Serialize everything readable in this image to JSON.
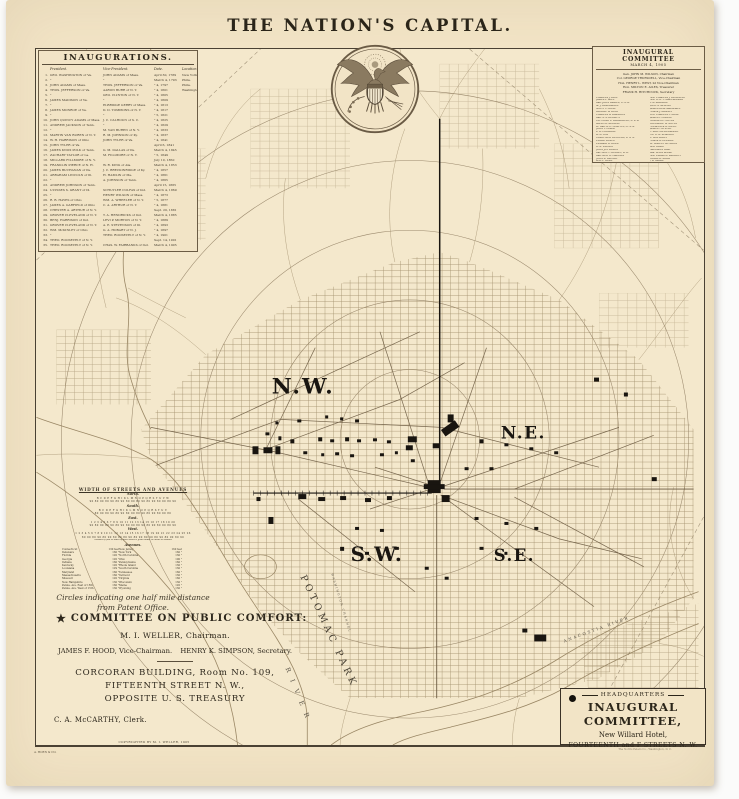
{
  "page": {
    "title": "THE NATION'S CAPITAL."
  },
  "colors": {
    "paper": "#f2e4c6",
    "ink": "#352e23",
    "black": "#191510",
    "map_line": "#9a8765",
    "map_dark": "#6b5a41",
    "map_faint": "#8a775a"
  },
  "inaugurations": {
    "title": "INAUGURATIONS.",
    "columns": {
      "president": "President.",
      "vice": "Vice-President.",
      "date": "Date.",
      "location": "Location."
    },
    "rows": [
      {
        "n": "1.",
        "president": "GEO. WASHINGTON of Va.",
        "vice": "JOHN ADAMS of Mass.",
        "date": "April 30, 1789",
        "loc": "New York"
      },
      {
        "n": "2.",
        "president": "\"",
        "vice": "\"",
        "date": "March 4, 1793",
        "loc": "Phila."
      },
      {
        "n": "3.",
        "president": "JOHN ADAMS of Mass.",
        "vice": "THOS. JEFFERSON of Va.",
        "date": "\" 4, 1797",
        "loc": "Phila."
      },
      {
        "n": "4.",
        "president": "THOS. JEFFERSON of Va.",
        "vice": "AARON BURR of N. Y.",
        "date": "\" 4, 1801",
        "loc": "Washington"
      },
      {
        "n": "5.",
        "president": "\"",
        "vice": "GEO. CLINTON of N. Y.",
        "date": "\" 4, 1805",
        "loc": ""
      },
      {
        "n": "6.",
        "president": "JAMES MADISON of Va.",
        "vice": "\"",
        "date": "\" 4, 1809",
        "loc": ""
      },
      {
        "n": "7.",
        "president": "\"",
        "vice": "ELBRIDGE GERRY of Mass.",
        "date": "\" 4, 1813",
        "loc": ""
      },
      {
        "n": "8.",
        "president": "JAMES MONROE of Va.",
        "vice": "D. D. TOMPKINS of N. Y.",
        "date": "\" 4, 1817",
        "loc": ""
      },
      {
        "n": "9.",
        "president": "\"",
        "vice": "\"",
        "date": "\" 5, 1821",
        "loc": ""
      },
      {
        "n": "10.",
        "president": "JOHN QUINCY ADAMS of Mass.",
        "vice": "J. C. CALHOUN of S. C.",
        "date": "\" 4, 1825",
        "loc": ""
      },
      {
        "n": "11.",
        "president": "ANDREW JACKSON of Tenn.",
        "vice": "\"",
        "date": "\" 4, 1829",
        "loc": ""
      },
      {
        "n": "12.",
        "president": "\"",
        "vice": "M. VAN BUREN of N. Y.",
        "date": "\" 4, 1833",
        "loc": ""
      },
      {
        "n": "13.",
        "president": "MARTIN VAN BUREN of N. Y.",
        "vice": "R. M. JOHNSON of Ky.",
        "date": "\" 4, 1837",
        "loc": ""
      },
      {
        "n": "14.",
        "president": "W. H. HARRISON of Ohio",
        "vice": "JOHN TYLER of Va.",
        "date": "\" 4, 1841",
        "loc": ""
      },
      {
        "n": "15.",
        "president": "JOHN TYLER of Va.",
        "vice": "",
        "date": "April 6, 1841",
        "loc": ""
      },
      {
        "n": "16.",
        "president": "JAMES KNOX POLK of Tenn.",
        "vice": "G. M. DALLAS of Pa.",
        "date": "March 4, 1845",
        "loc": ""
      },
      {
        "n": "17.",
        "president": "ZACHARY TAYLOR of La.",
        "vice": "M. FILLMORE of N. Y.",
        "date": "\" 5, 1849",
        "loc": ""
      },
      {
        "n": "18.",
        "president": "MILLARD FILLMORE of N. Y.",
        "vice": "",
        "date": "July 10, 1850",
        "loc": ""
      },
      {
        "n": "19.",
        "president": "FRANKLIN PIERCE of N. H.",
        "vice": "W. R. KING of Ala.",
        "date": "March 4, 1853",
        "loc": ""
      },
      {
        "n": "20.",
        "president": "JAMES BUCHANAN of Pa.",
        "vice": "J. C. BRECKINRIDGE of Ky.",
        "date": "\" 4, 1857",
        "loc": ""
      },
      {
        "n": "21.",
        "president": "ABRAHAM LINCOLN of Ill.",
        "vice": "H. HAMLIN of Me.",
        "date": "\" 4, 1861",
        "loc": ""
      },
      {
        "n": "22.",
        "president": "\"",
        "vice": "A. JOHNSON of Tenn.",
        "date": "\" 4, 1865",
        "loc": ""
      },
      {
        "n": "23.",
        "president": "ANDREW JOHNSON of Tenn.",
        "vice": "",
        "date": "April 15, 1865",
        "loc": ""
      },
      {
        "n": "24.",
        "president": "ULYSSES S. GRANT of Ill.",
        "vice": "SCHUYLER COLFAX of Ind.",
        "date": "March 4, 1869",
        "loc": ""
      },
      {
        "n": "25.",
        "president": "\"",
        "vice": "HENRY WILSON of Mass.",
        "date": "\" 4, 1873",
        "loc": ""
      },
      {
        "n": "26.",
        "president": "R. B. HAYES of Ohio",
        "vice": "WM. A. WHEELER of N. Y.",
        "date": "\" 5, 1877",
        "loc": ""
      },
      {
        "n": "27.",
        "president": "JAMES A. GARFIELD of Ohio",
        "vice": "C. A. ARTHUR of N. Y.",
        "date": "\" 4, 1881",
        "loc": ""
      },
      {
        "n": "28.",
        "president": "CHESTER A. ARTHUR of N. Y.",
        "vice": "",
        "date": "Sept. 20, 1881",
        "loc": ""
      },
      {
        "n": "29.",
        "president": "GROVER CLEVELAND of N. Y.",
        "vice": "T. A. HENDRICKS of Ind.",
        "date": "March 4, 1885",
        "loc": ""
      },
      {
        "n": "30.",
        "president": "BENJ. HARRISON of Ind.",
        "vice": "LEVI P. MORTON of N. Y.",
        "date": "\" 4, 1889",
        "loc": ""
      },
      {
        "n": "31.",
        "president": "GROVER CLEVELAND of N. Y.",
        "vice": "A. E. STEVENSON of Ill.",
        "date": "\" 4, 1893",
        "loc": ""
      },
      {
        "n": "32.",
        "president": "WM. McKINLEY of Ohio",
        "vice": "G. A. HOBART of N. J.",
        "date": "\" 4, 1897",
        "loc": ""
      },
      {
        "n": "33.",
        "president": "\"",
        "vice": "THEO. ROOSEVELT of N. Y.",
        "date": "\" 4, 1901",
        "loc": ""
      },
      {
        "n": "34.",
        "president": "THEO. ROOSEVELT of N. Y.",
        "vice": "",
        "date": "Sept. 14, 1901",
        "loc": ""
      },
      {
        "n": "35.",
        "president": "THEO. ROOSEVELT of N. Y.",
        "vice": "CHAS. W. FAIRBANKS of Ind.",
        "date": "March 4, 1905",
        "loc": ""
      }
    ]
  },
  "committee": {
    "title": "INAUGURAL COMMITTEE",
    "date": "MARCH 4, 1905",
    "officers": [
      "Gen. JOHN M. WILSON, Chairman",
      "Col. GEORGE TRUESDELL, Vice-Chairman",
      "Hon. HENRY L. WEST, 2d Vice-Chairman",
      "Hon. MILTON E. AILES, Treasurer",
      "FRANK H. HITCHCOCK, Secretary"
    ],
    "members_col1": [
      "CHARLES J. BELL",
      "JAMES F. BELL",
      "Gen. JOHN BIDDLE, U. S. A.",
      "M. J. BEARDMORE",
      "SCOTT C. BONE",
      "GEORGE W. BOYD",
      "CHARLES A. BRANDON",
      "Gen. S. S. BURDETT",
      "Col. CHAS. L. BROADWELL, U. S. A.",
      "ALLEN B. BROWNE",
      "Lt. Gen. A. R. CHAFFEE, U. S. A.",
      "JOHN T. CLARK",
      "L. A. COOLIDGE",
      "W. G. COX",
      "Comdr. GEO. DENFELD, U. S. N.",
      "ELMER DOVER",
      "EDWARD B. DREW",
      "H. B. DULANY",
      "JOHN JOY EDSON",
      "Rev. GEO. F. DUDLEY, D. D.",
      "Gen. GEO. H. HARRIES",
      "JOHN B. LARNER",
      "WM. F. GUDE",
      "CHAS. C. GLOVER",
      "E. SOUTHARD PARKER",
      "HENRY B. SPENCER"
    ],
    "members_col2": [
      "Hon. CHARLES J. BUCKNELL",
      "Hon. H. B. F. MACFARLAND",
      "T. W. MAGUIRE",
      "JOHN S. McLEAN",
      "JAMES ROSS MARSHALL",
      "FRANK J. MEANEY",
      "Prof. CHARLES F. MOLL",
      "JAMES L. NORRIS",
      "CHARLES L. NOYES",
      "THEODORE W. NOYES",
      "FREDERICK G. OWEN",
      "JAMES F. OYSTER",
      "C. MATTHEWS PARKER",
      "Col. R. W. PEARSON",
      "R. REA ROBEY",
      "FRANK G. REESIDE",
      "Dr. ROBERT REYBURN",
      "GIST BLAIR",
      "HARRISON GRAY",
      "Gen. ELLIS SPEAR",
      "Hon. EDGAR D. SARGENT",
      "EDGAR D. SHAW",
      "J. D. SMALL",
      "WM. H. SINGLETON",
      "DANIEL W. BAKER",
      "C. W. RICHARDSON"
    ]
  },
  "streets_note": {
    "title": "WIDTH OF STREETS AND AVENUES",
    "lines": [
      {
        "k": "h",
        "s": "North."
      },
      {
        "k": "r",
        "s": "B C D E F G H I K L M N O P Q R S T U V W"
      },
      {
        "k": "r",
        "s": "90 80 90 80 90 80 90 80 90 80 90 80 90 80 90 80 90"
      },
      {
        "k": "h",
        "s": "South."
      },
      {
        "k": "r",
        "s": "B C D E F G H I K L M N O P Q R S T U V"
      },
      {
        "k": "r",
        "s": "80 90 80 90 80 90 80 90 80 90 80 90 80 90 80"
      },
      {
        "k": "h",
        "s": "East."
      },
      {
        "k": "r",
        "s": "1 2 3 4 5 6 7 8 9 10 11 12 13 14 15 16 17 18 19 20"
      },
      {
        "k": "r",
        "s": "90 80 90 80 90 80 90 80 90 80 90 80 90 80 90 80 90"
      },
      {
        "k": "h",
        "s": "West."
      },
      {
        "k": "r",
        "s": "1 2 3 4 5 6 7 8 9 10 11 12 13 14 15 16 17 18 19 20 21 22 23 24 25 26"
      },
      {
        "k": "r",
        "s": "80 90 80 90 80 90 80 90 80 90 80 90 80 90 80 90 80 90 80 90"
      },
      {
        "k": "f",
        "s": "Number of feet in width of each street is given under its letter or number"
      }
    ],
    "avenues_title": "Avenues.",
    "avenues": [
      {
        "l": "Connecticut",
        "lw": "130 feet",
        "r": "New Jersey",
        "rw": "160 feet"
      },
      {
        "l": "Delaware",
        "lw": "160 \"",
        "r": "New York",
        "rw": "160 \""
      },
      {
        "l": "Florida",
        "lw": "120 \"",
        "r": "North Carolina",
        "rw": "130 \""
      },
      {
        "l": "Georgia",
        "lw": "120 \"",
        "r": "Ohio",
        "rw": "100 \""
      },
      {
        "l": "Indiana",
        "lw": "160 \"",
        "r": "Pennsylvania",
        "rw": "160 \""
      },
      {
        "l": "Kentucky",
        "lw": "120 \"",
        "r": "Rhode Island",
        "rw": "130 \""
      },
      {
        "l": "Louisiana",
        "lw": "129 \"",
        "r": "South Carolina",
        "rw": "130 \""
      },
      {
        "l": "Maryland",
        "lw": "160 \"",
        "r": "Tennessee",
        "rw": "160 \""
      },
      {
        "l": "Massachusetts",
        "lw": "160 \"",
        "r": "Vermont",
        "rw": "130 \""
      },
      {
        "l": "Missouri",
        "lw": "120 \"",
        "r": "Virginia",
        "rw": "160 \""
      },
      {
        "l": "New Hampshire",
        "lw": "130 \"",
        "r": "Wisconsin",
        "rw": "130 \""
      },
      {
        "l": "Penna. Ave. East of 15th",
        "lw": "160 \"",
        "r": "Maine",
        "rw": "120 \""
      },
      {
        "l": "Penna. Ave. West of 15th",
        "lw": "130 \"",
        "r": "Wyoming",
        "rw": "130 \""
      }
    ],
    "caption": "Circles indicating one half mile distance from Patent Office."
  },
  "public_comfort": {
    "star": "★",
    "title": "COMMITTEE ON PUBLIC COMFORT:",
    "chairman": "M. I. WELLER, Chairman.",
    "vice_chairman": "JAMES F. HOOD, Vice-Chairman.",
    "secretary": "HENRY K. SIMPSON, Secretary.",
    "building_line1": "CORCORAN BUILDING, Room No. 109,",
    "building_line2": "FIFTEENTH STREET N. W.,",
    "building_line3": "OPPOSITE U. S. TREASURY",
    "clerk": "C. A. McCARTHY, Clerk."
  },
  "headquarters": {
    "label": "HEADQUARTERS",
    "title": "INAUGURAL COMMITTEE,",
    "hotel": "New Willard Hotel,",
    "address": "FOURTEENTH and F STREETS N. W."
  },
  "map": {
    "labels": {
      "nw": "N.W.",
      "ne": "N.E.",
      "sw": "S.W.",
      "se": "S.E.",
      "potomac_park": "POTOMAC PARK",
      "river": "RIVER",
      "washington_channel": "WASHINGTON CHANNEL",
      "anacostia": "ANACOSTIA RIVER"
    }
  },
  "footer": {
    "copyright": "COPYRIGHTED BY M. I. WELLER, 1905",
    "lith": "A. HOEN & CO.",
    "press": "The Norris Peters Co., Washington, D. C."
  }
}
